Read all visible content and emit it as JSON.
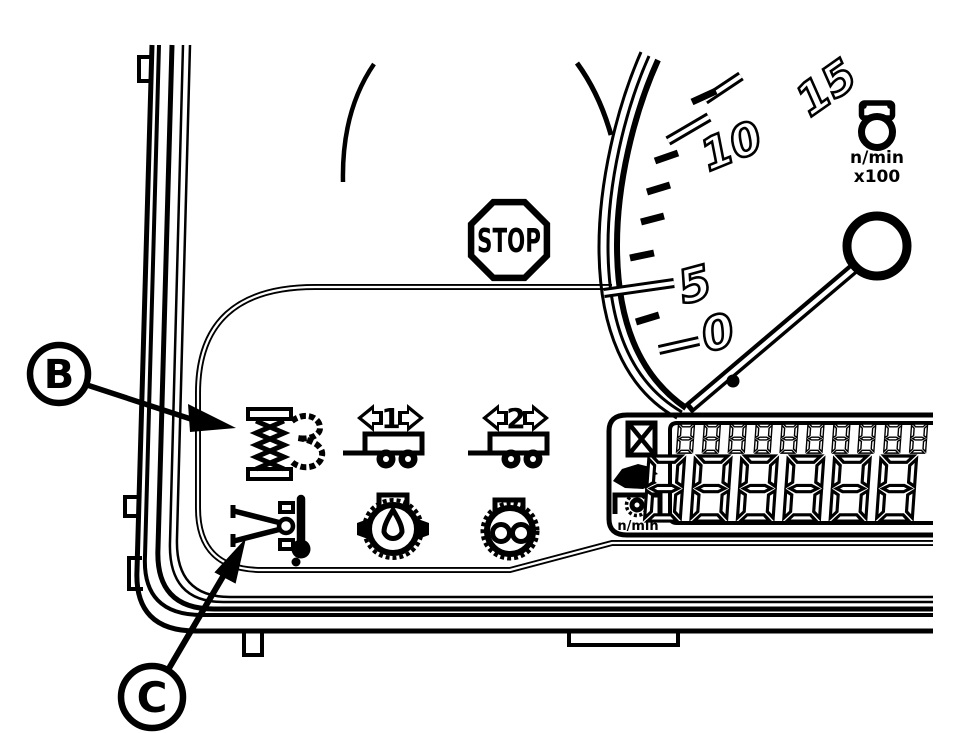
{
  "callouts": {
    "b_label": "B",
    "c_label": "C"
  },
  "stop_label": "STOP",
  "tachometer": {
    "tick_labels": [
      "0",
      "5",
      "10",
      "15"
    ],
    "unit_line1": "n/min",
    "unit_line2": "x100"
  },
  "trailers": {
    "trailer1_label": "1",
    "trailer2_label": "2"
  },
  "lcd": {
    "top_digits": "8888888888",
    "main_digits": "888888",
    "unit_label": "n/min"
  },
  "icons": {
    "stop": "stop-octagon",
    "bulb": "warning-lamp-bulb",
    "b_target": "transmission-gears-warning",
    "c_target": "axle-oil-temperature",
    "thermometer": "thermometer",
    "trailer1": "trailer-1-turn-signal",
    "trailer2": "trailer-2-turn-signal",
    "oil": "engine-oil-pressure",
    "air": "transmission-oil-pressure",
    "hourglass": "hourglass",
    "service": "service-wrench",
    "pto": "pto-gear-speed"
  },
  "colors": {
    "ink": "#000000",
    "paper": "#ffffff"
  }
}
